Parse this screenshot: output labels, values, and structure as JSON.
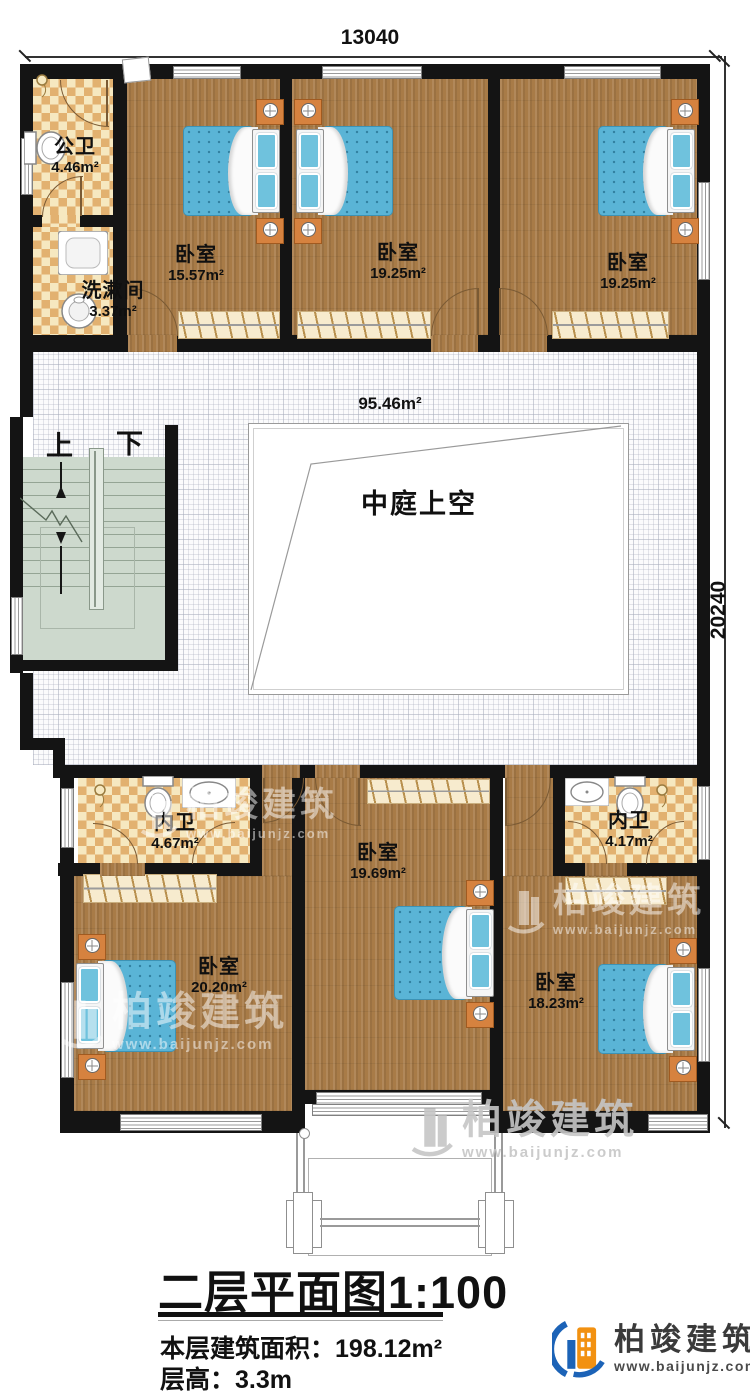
{
  "dimensions": {
    "top": "13040",
    "right": "20240"
  },
  "hall": {
    "area": "95.46m²"
  },
  "atrium": {
    "label": "中庭上空"
  },
  "stairs": {
    "up": "上",
    "down": "下"
  },
  "rooms": {
    "public_bath": {
      "name": "公卫",
      "area": "4.46m²"
    },
    "washroom": {
      "name": "洗漱间",
      "area": "3.37m²"
    },
    "bedroom_top_left": {
      "name": "卧室",
      "area": "15.57m²"
    },
    "bedroom_top_mid": {
      "name": "卧室",
      "area": "19.25m²"
    },
    "bedroom_top_right": {
      "name": "卧室",
      "area": "19.25m²"
    },
    "ensuite_left": {
      "name": "内卫",
      "area": "4.67m²"
    },
    "bedroom_bottom_mid": {
      "name": "卧室",
      "area": "19.69m²"
    },
    "ensuite_right": {
      "name": "内卫",
      "area": "4.17m²"
    },
    "bedroom_bottom_left": {
      "name": "卧室",
      "area": "20.20m²"
    },
    "bedroom_bottom_right": {
      "name": "卧室",
      "area": "18.23m²"
    }
  },
  "title": {
    "main": "二层平面图",
    "scale": "1:100",
    "area_label": "本层建筑面积：",
    "area_value": "198.12m²",
    "height_label": "层高：",
    "height_value": "3.3m"
  },
  "logo": {
    "name": "柏竣建筑",
    "url": "www.baijunjz.com"
  },
  "watermark": {
    "name": "柏竣建筑",
    "url": "www.baijunjz.com"
  },
  "colors": {
    "wall": "#141414",
    "wood": "#a87b47",
    "tile_dark": "#e2b170",
    "tile_light": "#f6e8c0",
    "stair": "#cdd9cd",
    "bed": "#5ab4d6",
    "logo_blue": "#1c63b7",
    "logo_orange": "#f29111"
  }
}
